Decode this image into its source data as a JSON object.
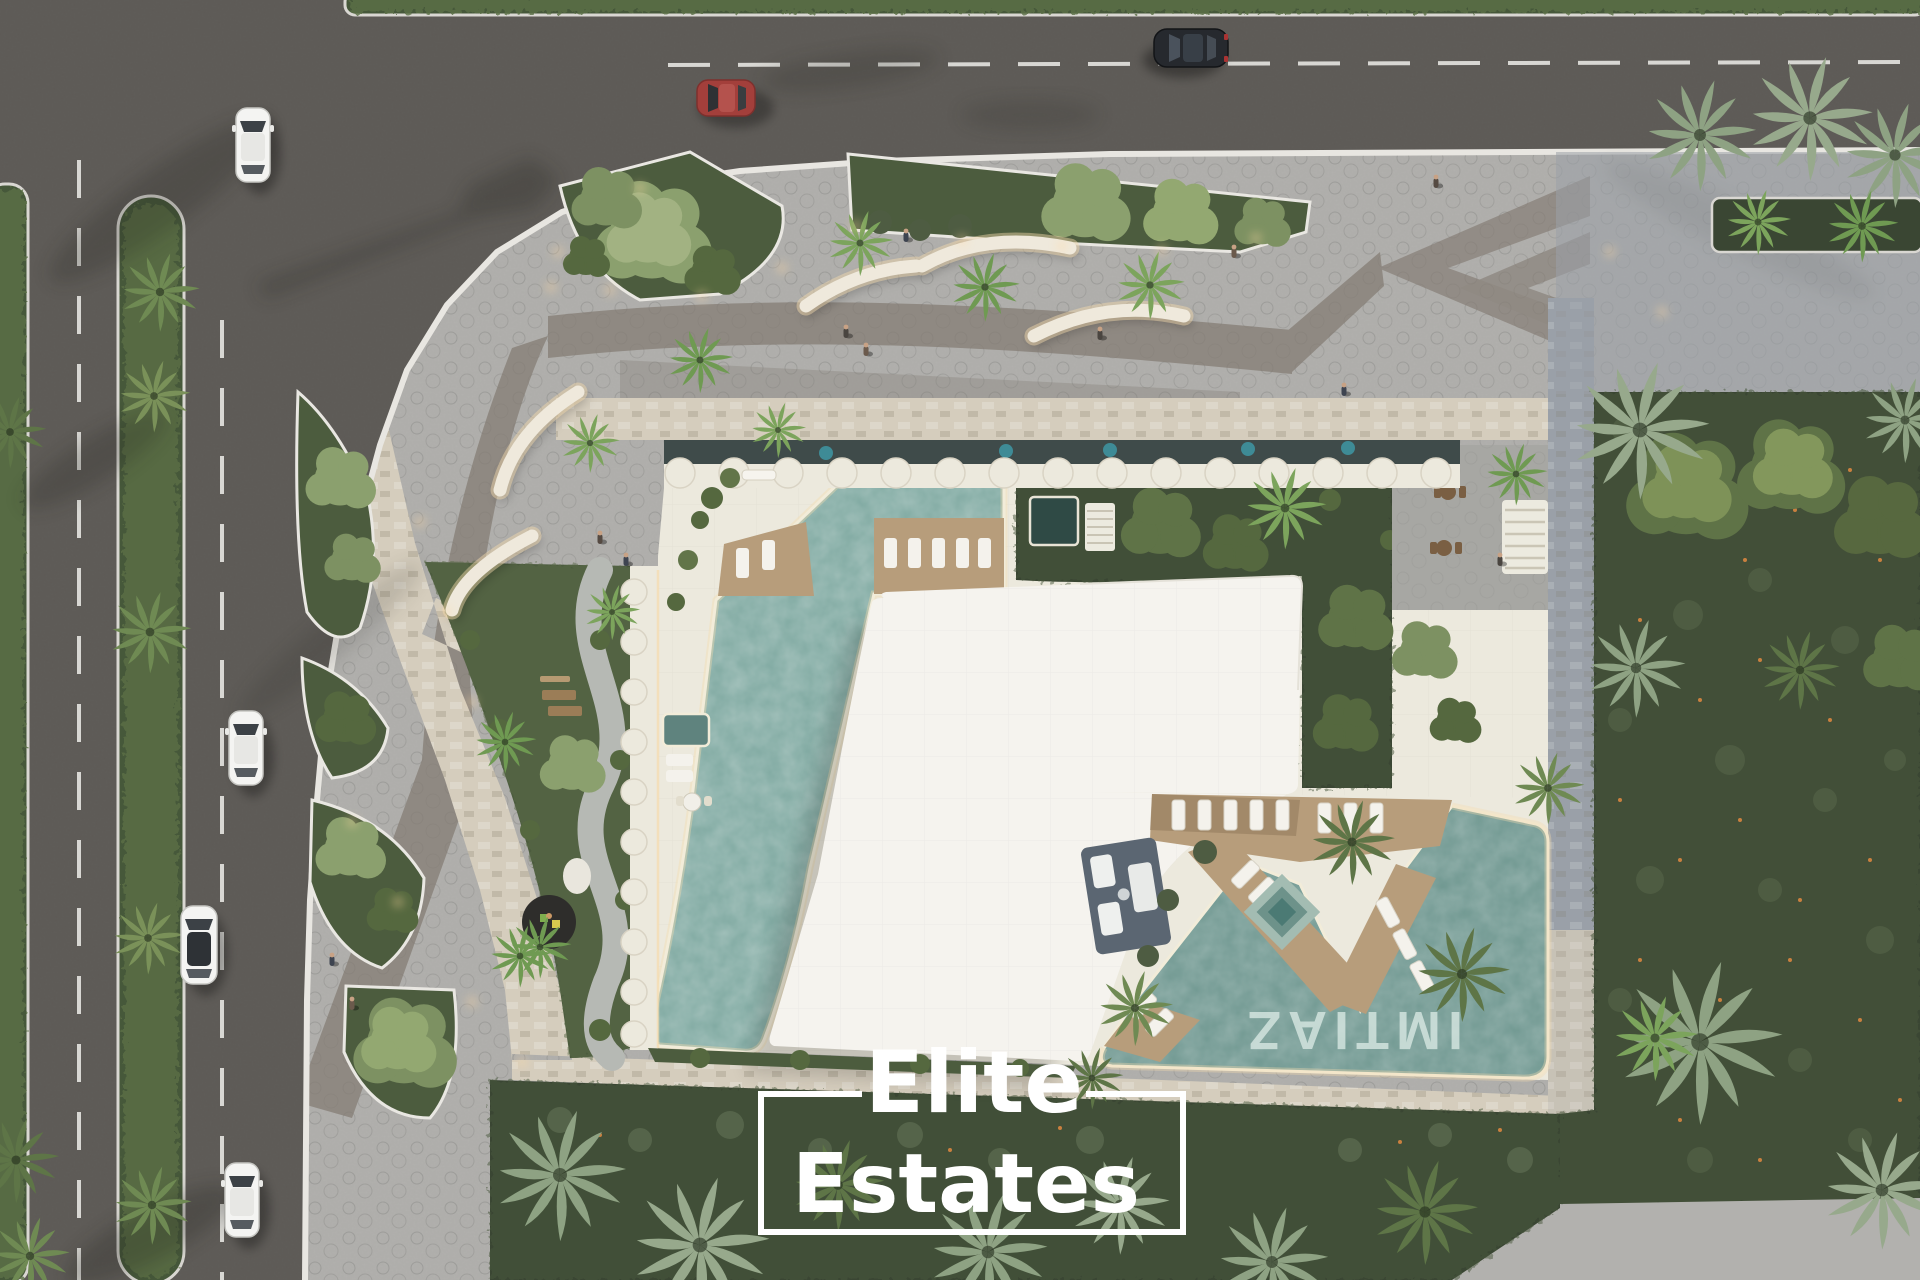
{
  "scene": {
    "type": "aerial-architectural-render",
    "description": "Top-down 3D rendering of a residential development: L-shaped white roof building with rooftop lap pool, leisure pool, gardens and landscaped plaza, bordered by asphalt roads with cars on the left and top, and a dark green park on the right"
  },
  "watermark": {
    "line1": "Elite",
    "line2": "Estates"
  },
  "pool_branding": {
    "text": "IMTIAZ",
    "rotation_deg": 180,
    "location": "bottom of leisure pool"
  },
  "palette": {
    "asphalt": "#5b5955",
    "asphalt-light": "#6e6b66",
    "plaza": "#b2b1ae",
    "plaza-shade": "#9aa0a8",
    "promenade": "#8f8982",
    "cream": "#d5cdbd",
    "speck": "#a9a094",
    "roof": "#f5f3ee",
    "deck": "#ece9dd",
    "wood": "#b79d7b",
    "wood-dark": "#8d7557",
    "water": "#7fa9a1",
    "water-dark": "#5f837e",
    "spa": "#2f4a45",
    "lawn": "#4c5c3e",
    "lawn-dark": "#3a4633",
    "hedge": "#46583a",
    "curb": "#e8e6e1",
    "glow": "#f6dcae",
    "glass": "#3f4b4a",
    "teal-dot": "#3e8b96",
    "car-red": "#a33f3b",
    "car-dark": "#26292e",
    "car-white": "#f4f4f2"
  },
  "inventory": {
    "cars": [
      {
        "color": "white",
        "road": "left-vertical",
        "heading": "south"
      },
      {
        "color": "red",
        "road": "top-horizontal",
        "heading": "west"
      },
      {
        "color": "dark-gray",
        "road": "top-horizontal",
        "heading": "west"
      },
      {
        "color": "white",
        "road": "left-vertical",
        "heading": "south"
      },
      {
        "color": "white-suv",
        "road": "left-vertical",
        "heading": "south"
      },
      {
        "color": "white",
        "road": "left-vertical",
        "heading": "south"
      }
    ],
    "pools": [
      "rooftop-lap-pool",
      "plunge-pool",
      "spa-diamond",
      "leisure-pool-with-branding"
    ],
    "benches": 5,
    "green_islands": 6,
    "park": "right-side park with palm trees and flowering groundcover",
    "roads": {
      "vertical_lanes_dashed": 2,
      "horizontal_center_dash": 1
    }
  }
}
